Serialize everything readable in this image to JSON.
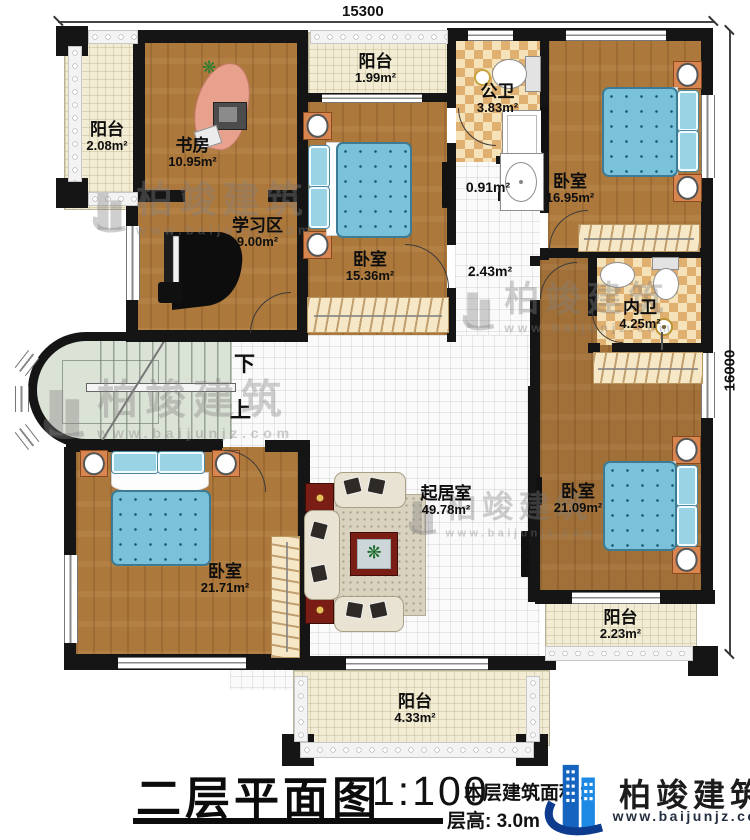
{
  "plan": {
    "dim_top": "15300",
    "dim_right": "16000",
    "stairs_down": "下",
    "stairs_up": "上",
    "rooms": {
      "balcony_tl": {
        "name": "阳台",
        "area": "2.08m²"
      },
      "study": {
        "name": "书房",
        "area": "10.95m²"
      },
      "study_area": {
        "name": "学习区",
        "area": "9.00m²"
      },
      "balcony_top": {
        "name": "阳台",
        "area": "1.99m²"
      },
      "bedroom_top": {
        "name": "卧室",
        "area": "15.36m²"
      },
      "bath_public": {
        "name": "公卫",
        "area": "3.83m²"
      },
      "wash": {
        "area": "0.91m²"
      },
      "bedroom_tr": {
        "name": "卧室",
        "area": "16.95m²"
      },
      "hall": {
        "area": "2.43m²"
      },
      "bath_inner": {
        "name": "内卫",
        "area": "4.25m²"
      },
      "bedroom_right": {
        "name": "卧室",
        "area": "21.09m²"
      },
      "living": {
        "name": "起居室",
        "area": "49.78m²"
      },
      "bedroom_bl": {
        "name": "卧室",
        "area": "21.71m²"
      },
      "balcony_right": {
        "name": "阳台",
        "area": "2.23m²"
      },
      "balcony_bottom": {
        "name": "阳台",
        "area": "4.33m²"
      }
    }
  },
  "title_block": {
    "title": "二层平面图",
    "scale": "1:100",
    "area_note": "本层建筑面积：",
    "height_note": "层高: 3.0m"
  },
  "branding": {
    "company": "柏竣建筑",
    "website": "www.baijunjz.com"
  },
  "colors": {
    "wall": "#151515",
    "wood_floor": "#ad783c",
    "mattress_blue": "#79c2da",
    "bath_checker": "#dfb070",
    "logo_blue": "#1565c0"
  }
}
